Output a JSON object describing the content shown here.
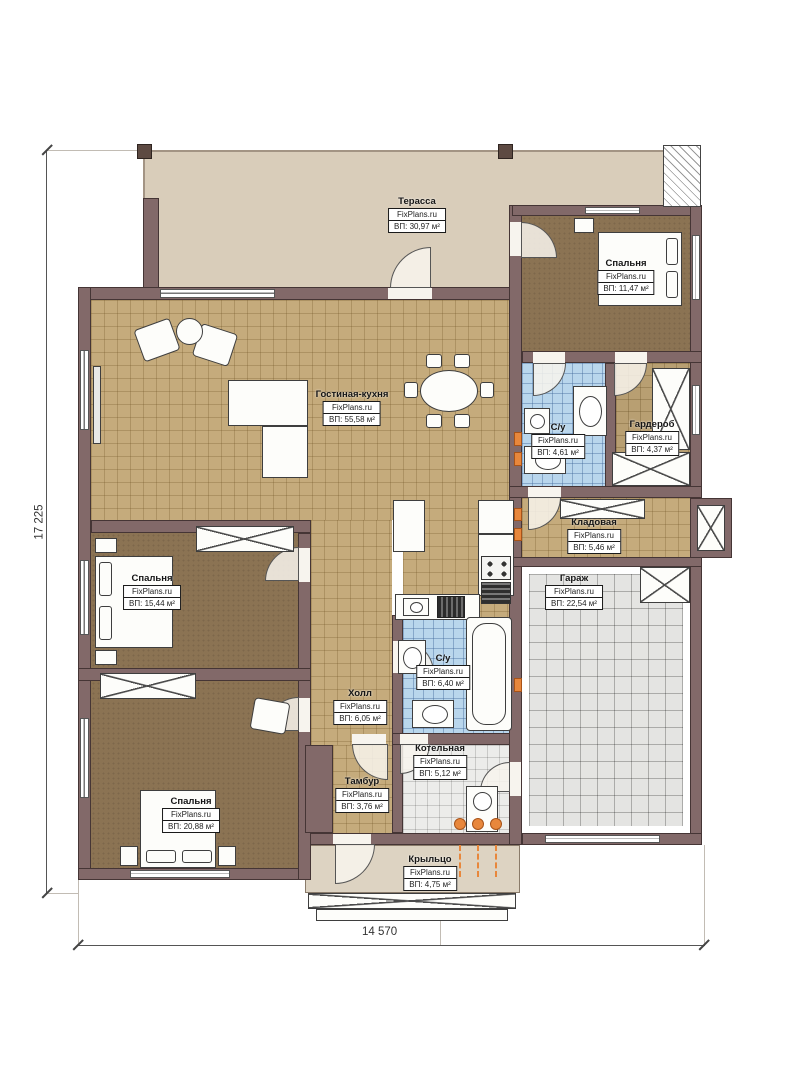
{
  "plan": {
    "watermark": "FixPlans.ru",
    "rooms": [
      {
        "id": "terrace",
        "name": "Терасса",
        "area": "ВП: 30,97 м²"
      },
      {
        "id": "bedroom-top-right",
        "name": "Спальня",
        "area": "ВП: 11,47 м²"
      },
      {
        "id": "living-kitchen",
        "name": "Гостиная-кухня",
        "area": "ВП: 55,58 м²"
      },
      {
        "id": "bathroom-top",
        "name": "С/у",
        "area": "ВП: 4,61 м²"
      },
      {
        "id": "wardrobe-room",
        "name": "Гардероб",
        "area": "ВП: 4,37 м²"
      },
      {
        "id": "storage",
        "name": "Кладовая",
        "area": "ВП: 5,46 м²"
      },
      {
        "id": "garage",
        "name": "Гараж",
        "area": "ВП: 22,54 м²"
      },
      {
        "id": "bedroom-left",
        "name": "Спальня",
        "area": "ВП: 15,44 м²"
      },
      {
        "id": "bathroom-main",
        "name": "С/у",
        "area": "ВП: 6,40 м²"
      },
      {
        "id": "hall",
        "name": "Холл",
        "area": "ВП: 6,05 м²"
      },
      {
        "id": "boiler-room",
        "name": "Котельная",
        "area": "ВП: 5,12 м²"
      },
      {
        "id": "vestibule",
        "name": "Тамбур",
        "area": "ВП: 3,76 м²"
      },
      {
        "id": "bedroom-bottom",
        "name": "Спальня",
        "area": "ВП: 20,88 м²"
      },
      {
        "id": "porch",
        "name": "Крыльцо",
        "area": "ВП: 4,75 м²"
      }
    ],
    "dimensions": {
      "vertical": "17 225",
      "horizontal": "14 570"
    },
    "colors": {
      "wall": "#826969",
      "terrace_floor": "#d9cdba",
      "tan_tile": "#c5ab7c",
      "blue_tile": "#b9d6ec",
      "carpet": "#8b7353",
      "garage_tile": "#e4e4e2",
      "radiator": "#e8873c"
    }
  }
}
